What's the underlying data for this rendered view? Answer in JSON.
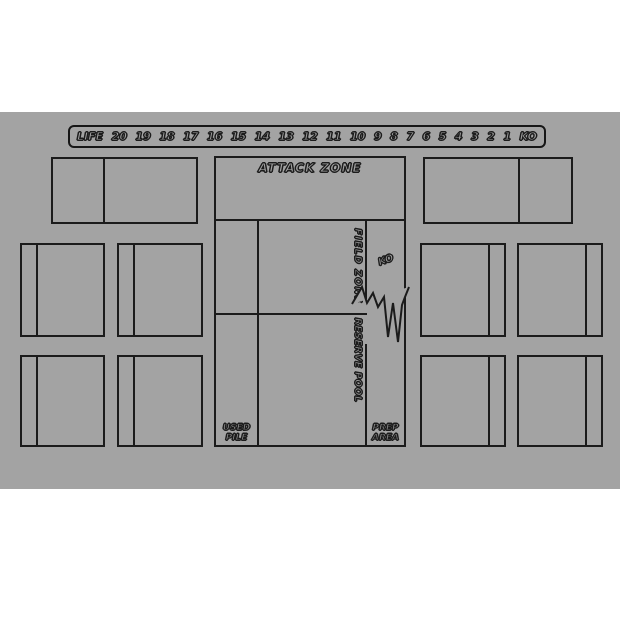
{
  "mat": {
    "bg_color": "#a3a3a3",
    "line_color": "#1b1b1b",
    "life_track": {
      "label": "LIFE",
      "values": [
        "20",
        "19",
        "18",
        "17",
        "16",
        "15",
        "14",
        "13",
        "12",
        "11",
        "10",
        "9",
        "8",
        "7",
        "6",
        "5",
        "4",
        "3",
        "2",
        "1",
        "KO"
      ]
    },
    "zones": {
      "attack": {
        "label": "ATTACK ZONE"
      },
      "field": {
        "label": "FIELD ZONE"
      },
      "reserve": {
        "label": "RESERVE POOL"
      },
      "ko": {
        "label": "KO"
      },
      "used_pile": {
        "line1": "USED",
        "line2": "PILE"
      },
      "prep_area": {
        "line1": "PREP",
        "line2": "AREA"
      }
    }
  }
}
